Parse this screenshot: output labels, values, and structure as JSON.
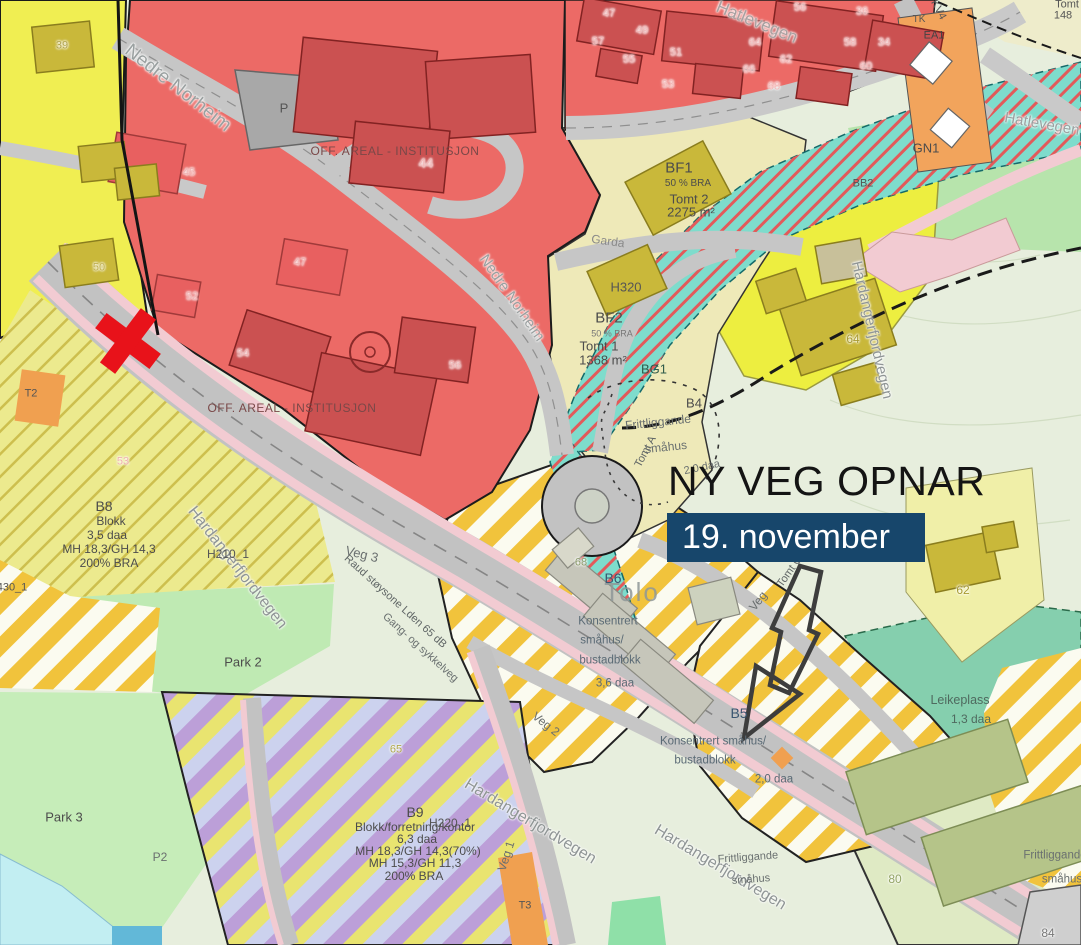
{
  "overlay": {
    "headline": "NY VEG OPNAR",
    "banner_text": "19. november"
  },
  "palette": {
    "banner_bg": "#17466b",
    "banner_text": "#ffffff",
    "headline": "#141414",
    "marker_red": "#e8121a",
    "arrow_outline": "#3d3d3d",
    "institution_red": "#ec6a66",
    "building_red": "#cb5151",
    "residential_yellow": "#f0ee52",
    "plan_pale": "#eee9b8",
    "bright_yellow": "#edee40",
    "stripe_yellow": "#f1c33c",
    "stripe_purple": "#bc9fd8",
    "stripe_lavender": "#ccd2ee",
    "green_area": "#bfe9b2",
    "play_teal": "#85cfae",
    "stream_cyan": "#7edccc",
    "road_gray": "#c2c2c2",
    "path_pink": "#f2cbd2",
    "orange": "#f2a45c",
    "water": "#c2eef2"
  },
  "map": {
    "labels": [
      {
        "t": "Nedre Norheim",
        "x": 178,
        "y": 88,
        "s": 19,
        "c": "#9aa0a0",
        "r": 38,
        "hl": 1
      },
      {
        "t": "Nedre Norheim",
        "x": 512,
        "y": 298,
        "s": 15,
        "c": "#9aa0a0",
        "r": 55,
        "hl": 1
      },
      {
        "t": "Hatlevegen",
        "x": 757,
        "y": 22,
        "s": 17,
        "c": "#a8a0a0",
        "r": 22,
        "hl": 1
      },
      {
        "t": "Hatlevegen",
        "x": 1042,
        "y": 124,
        "s": 15,
        "c": "#9aa0a0",
        "r": 10,
        "hl": 1
      },
      {
        "t": "Hardangerfjordvegen",
        "x": 237,
        "y": 568,
        "s": 16,
        "c": "#8f9595",
        "r": 52,
        "hl": 1
      },
      {
        "t": "Hardangerfjordvegen",
        "x": 872,
        "y": 330,
        "s": 15,
        "c": "#8f9595",
        "r": 77,
        "hl": 1
      },
      {
        "t": "Hardangerfjordvegen",
        "x": 530,
        "y": 822,
        "s": 16,
        "c": "#8f9595",
        "r": 31,
        "hl": 1
      },
      {
        "t": "Hardangerfjordvegen",
        "x": 720,
        "y": 868,
        "s": 16,
        "c": "#8f9595",
        "r": 31,
        "hl": 1
      },
      {
        "t": "Veg 3",
        "x": 362,
        "y": 554,
        "s": 13,
        "c": "#6a6f6f",
        "r": 14
      },
      {
        "t": "Veg 2",
        "x": 546,
        "y": 724,
        "s": 12,
        "c": "#6a6f6f",
        "r": 38
      },
      {
        "t": "Veg 1",
        "x": 506,
        "y": 856,
        "s": 12,
        "c": "#6a6f6f",
        "r": -72
      },
      {
        "t": "Veg",
        "x": 758,
        "y": 601,
        "s": 12,
        "c": "#6a6f6f",
        "r": -52
      },
      {
        "t": "Garda",
        "x": 608,
        "y": 241,
        "s": 12,
        "c": "#8a8a8a",
        "r": 8
      },
      {
        "t": "Raud støysone Lden 65 dB",
        "x": 395,
        "y": 602,
        "s": 11,
        "c": "#5f6565",
        "r": 42
      },
      {
        "t": "Gang- og sykkelveg",
        "x": 420,
        "y": 648,
        "s": 11,
        "c": "#6a7070",
        "r": 42
      },
      {
        "t": "BF1",
        "x": 679,
        "y": 168,
        "s": 15
      },
      {
        "t": "50 % BRA",
        "x": 688,
        "y": 184,
        "s": 10
      },
      {
        "t": "Tomt 2",
        "x": 689,
        "y": 199,
        "s": 13
      },
      {
        "t": "2275 m²",
        "x": 691,
        "y": 212,
        "s": 13
      },
      {
        "t": "H320",
        "x": 626,
        "y": 287,
        "s": 13,
        "c": "#555555"
      },
      {
        "t": "BF2",
        "x": 609,
        "y": 318,
        "s": 15
      },
      {
        "t": "50 % BRA",
        "x": 612,
        "y": 334,
        "s": 9,
        "c": "#777777"
      },
      {
        "t": "Tomt 1",
        "x": 599,
        "y": 346,
        "s": 13
      },
      {
        "t": "1368 m²",
        "x": 603,
        "y": 360,
        "s": 13
      },
      {
        "t": "BG1",
        "x": 654,
        "y": 369,
        "s": 13,
        "c": "#2f5a4a"
      },
      {
        "t": "B4",
        "x": 694,
        "y": 403,
        "s": 13
      },
      {
        "t": "Frittliggande",
        "x": 658,
        "y": 422,
        "s": 12,
        "c": "#6a7070",
        "r": -6
      },
      {
        "t": "småhus",
        "x": 666,
        "y": 447,
        "s": 12,
        "c": "#6a7070",
        "r": -6
      },
      {
        "t": "Tomt A",
        "x": 646,
        "y": 452,
        "s": 11,
        "c": "#5f6565",
        "r": -62
      },
      {
        "t": "2,0 daa",
        "x": 702,
        "y": 468,
        "s": 11,
        "c": "#6a7070",
        "r": -12
      },
      {
        "t": "Tomt C",
        "x": 790,
        "y": 572,
        "s": 11,
        "c": "#5f6565",
        "r": -55
      },
      {
        "t": "B6",
        "x": 613,
        "y": 578,
        "s": 14,
        "c": "#3a5570"
      },
      {
        "t": "Tolo",
        "x": 632,
        "y": 592,
        "s": 26,
        "c": "#8f9898",
        "o": 0.85,
        "ls": 2
      },
      {
        "t": "Konsentrert",
        "x": 608,
        "y": 622,
        "s": 11.5,
        "c": "#5a6a75"
      },
      {
        "t": "småhus/",
        "x": 602,
        "y": 641,
        "s": 11.5,
        "c": "#5a6a75"
      },
      {
        "t": "bustadblokk",
        "x": 610,
        "y": 661,
        "s": 11.5,
        "c": "#5a6a75"
      },
      {
        "t": "3,6 daa",
        "x": 615,
        "y": 684,
        "s": 11.5,
        "c": "#5a6a75"
      },
      {
        "t": "B5",
        "x": 739,
        "y": 713,
        "s": 14,
        "c": "#3a5570"
      },
      {
        "t": "Konsentrert småhus/",
        "x": 713,
        "y": 742,
        "s": 11.5,
        "c": "#5a6a75"
      },
      {
        "t": "bustadblokk",
        "x": 705,
        "y": 761,
        "s": 11.5,
        "c": "#5a6a75"
      },
      {
        "t": "2,0 daa",
        "x": 774,
        "y": 780,
        "s": 11.5,
        "c": "#5a6a75"
      },
      {
        "t": "B8",
        "x": 104,
        "y": 506,
        "s": 14
      },
      {
        "t": "Blokk",
        "x": 111,
        "y": 521,
        "s": 12
      },
      {
        "t": "3,5 daa",
        "x": 107,
        "y": 535,
        "s": 12
      },
      {
        "t": "MH 18,3/GH 14,3",
        "x": 109,
        "y": 549,
        "s": 12
      },
      {
        "t": "200% BRA",
        "x": 109,
        "y": 563,
        "s": 12
      },
      {
        "t": "H210_1",
        "x": 228,
        "y": 554,
        "s": 12,
        "c": "#555555"
      },
      {
        "t": "B9",
        "x": 415,
        "y": 812,
        "s": 14
      },
      {
        "t": "Blokk/forretning/kontor",
        "x": 415,
        "y": 827,
        "s": 12
      },
      {
        "t": "6,3 daa",
        "x": 417,
        "y": 839,
        "s": 12
      },
      {
        "t": "MH 18,3/GH 14,3(70%)",
        "x": 418,
        "y": 851,
        "s": 12
      },
      {
        "t": "MH 15,3/GH 11,3",
        "x": 415,
        "y": 863,
        "s": 12
      },
      {
        "t": "200% BRA",
        "x": 414,
        "y": 876,
        "s": 12
      },
      {
        "t": "H220_1",
        "x": 450,
        "y": 823,
        "s": 12,
        "c": "#555555"
      },
      {
        "t": "Park 2",
        "x": 243,
        "y": 662,
        "s": 13
      },
      {
        "t": "Park 3",
        "x": 64,
        "y": 817,
        "s": 13
      },
      {
        "t": "P2",
        "x": 160,
        "y": 857,
        "s": 12,
        "c": "#6a6f6f"
      },
      {
        "t": "P",
        "x": 284,
        "y": 108,
        "s": 13,
        "c": "#555555"
      },
      {
        "t": "GN1",
        "x": 926,
        "y": 148,
        "s": 13
      },
      {
        "t": "Leikeplass",
        "x": 960,
        "y": 700,
        "s": 12.5,
        "c": "#4f6a5f"
      },
      {
        "t": "1,3 daa",
        "x": 971,
        "y": 719,
        "s": 12,
        "c": "#4f6a5f"
      },
      {
        "t": "Frittliggande",
        "x": 1055,
        "y": 856,
        "s": 11.5,
        "c": "#6a7070"
      },
      {
        "t": "småhus",
        "x": 1062,
        "y": 880,
        "s": 11.5,
        "c": "#6a7070"
      },
      {
        "t": "Frittliggande",
        "x": 748,
        "y": 858,
        "s": 11,
        "c": "#6a7070",
        "r": -4
      },
      {
        "t": "småhus",
        "x": 751,
        "y": 880,
        "s": 11,
        "c": "#6a7070",
        "r": -4
      },
      {
        "t": "KV4",
        "x": 938,
        "y": 10,
        "s": 11,
        "c": "#555555",
        "r": 62
      },
      {
        "t": "EA1",
        "x": 934,
        "y": 36,
        "s": 11,
        "c": "#444444"
      },
      {
        "t": "TK",
        "x": 919,
        "y": 20,
        "s": 10,
        "c": "#555555"
      },
      {
        "t": "BB2",
        "x": 863,
        "y": 184,
        "s": 11,
        "c": "#555555"
      },
      {
        "t": "Tomt",
        "x": 1067,
        "y": 5,
        "s": 11,
        "c": "#555555"
      },
      {
        "t": "148",
        "x": 1063,
        "y": 16,
        "s": 11,
        "c": "#555555"
      },
      {
        "t": "T2",
        "x": 31,
        "y": 394,
        "s": 11,
        "c": "#555555"
      },
      {
        "t": "T3",
        "x": 525,
        "y": 906,
        "s": 11,
        "c": "#555555"
      },
      {
        "t": "430_1",
        "x": 12,
        "y": 588,
        "s": 11,
        "c": "#555555"
      },
      {
        "t": "OFF. AREAL - INSTITUSJON",
        "x": 395,
        "y": 151,
        "s": 12,
        "c": "#7a4848",
        "ls": 0.5
      },
      {
        "t": "OFF. AREAL - INSTITUSJON",
        "x": 292,
        "y": 408,
        "s": 12,
        "c": "#7a4848",
        "ls": 0.5
      },
      {
        "t": "44",
        "x": 426,
        "y": 163,
        "s": 13,
        "c": "#f2b6b6",
        "hl": 1
      },
      {
        "t": "39",
        "x": 62,
        "y": 46,
        "s": 11,
        "c": "#b0a24a",
        "hl": 1
      },
      {
        "t": "45",
        "x": 189,
        "y": 173,
        "s": 11,
        "c": "#f0b0b0",
        "hl": 1
      },
      {
        "t": "47",
        "x": 300,
        "y": 263,
        "s": 11,
        "c": "#f0b0b0",
        "hl": 1
      },
      {
        "t": "50",
        "x": 99,
        "y": 268,
        "s": 11,
        "c": "#c0b050",
        "hl": 1
      },
      {
        "t": "52",
        "x": 192,
        "y": 297,
        "s": 11,
        "c": "#f0b0b0",
        "hl": 1
      },
      {
        "t": "53",
        "x": 123,
        "y": 462,
        "s": 11,
        "c": "#f0b0b0",
        "hl": 1
      },
      {
        "t": "54",
        "x": 243,
        "y": 354,
        "s": 11,
        "c": "#f0b0b0",
        "hl": 1
      },
      {
        "t": "56",
        "x": 455,
        "y": 366,
        "s": 11,
        "c": "#f0b0b0",
        "hl": 1
      },
      {
        "t": "47",
        "x": 609,
        "y": 14,
        "s": 11,
        "c": "#f2b6b6",
        "hl": 1
      },
      {
        "t": "49",
        "x": 642,
        "y": 31,
        "s": 11,
        "c": "#f2b6b6",
        "hl": 1
      },
      {
        "t": "57",
        "x": 598,
        "y": 42,
        "s": 11,
        "c": "#f2b6b6",
        "hl": 1
      },
      {
        "t": "55",
        "x": 629,
        "y": 60,
        "s": 11,
        "c": "#f2b6b6",
        "hl": 1
      },
      {
        "t": "51",
        "x": 676,
        "y": 53,
        "s": 11,
        "c": "#f2b6b6",
        "hl": 1
      },
      {
        "t": "53",
        "x": 668,
        "y": 85,
        "s": 11,
        "c": "#f2b6b6",
        "hl": 1
      },
      {
        "t": "64",
        "x": 755,
        "y": 43,
        "s": 11,
        "c": "#f2b6b6",
        "hl": 1
      },
      {
        "t": "66",
        "x": 749,
        "y": 70,
        "s": 11,
        "c": "#f2b6b6",
        "hl": 1
      },
      {
        "t": "68",
        "x": 774,
        "y": 87,
        "s": 11,
        "c": "#f2b6b6",
        "hl": 1
      },
      {
        "t": "62",
        "x": 786,
        "y": 60,
        "s": 11,
        "c": "#f2b6b6",
        "hl": 1
      },
      {
        "t": "56",
        "x": 800,
        "y": 8,
        "s": 11,
        "c": "#f2b6b6",
        "hl": 1
      },
      {
        "t": "58",
        "x": 850,
        "y": 43,
        "s": 11,
        "c": "#f2b6b6",
        "hl": 1
      },
      {
        "t": "36",
        "x": 862,
        "y": 12,
        "s": 11,
        "c": "#f2b6b6",
        "hl": 1
      },
      {
        "t": "34",
        "x": 884,
        "y": 43,
        "s": 11,
        "c": "#f2b6b6",
        "hl": 1
      },
      {
        "t": "60",
        "x": 866,
        "y": 67,
        "s": 11,
        "c": "#f2b6b6",
        "hl": 1
      },
      {
        "t": "64",
        "x": 853,
        "y": 339,
        "s": 12,
        "c": "#a89a30",
        "hl": 1
      },
      {
        "t": "62",
        "x": 963,
        "y": 590,
        "s": 12,
        "c": "#a89a30",
        "hl": 1
      },
      {
        "t": "65",
        "x": 396,
        "y": 750,
        "s": 11,
        "c": "#b0a84a",
        "hl": 1
      },
      {
        "t": "68",
        "x": 581,
        "y": 563,
        "s": 11,
        "c": "#8a9a6a",
        "hl": 1
      },
      {
        "t": "80",
        "x": 895,
        "y": 879,
        "s": 12,
        "c": "#93a465",
        "hl": 1
      },
      {
        "t": "84",
        "x": 1048,
        "y": 933,
        "s": 12,
        "c": "#777777",
        "hl": 1
      }
    ]
  }
}
